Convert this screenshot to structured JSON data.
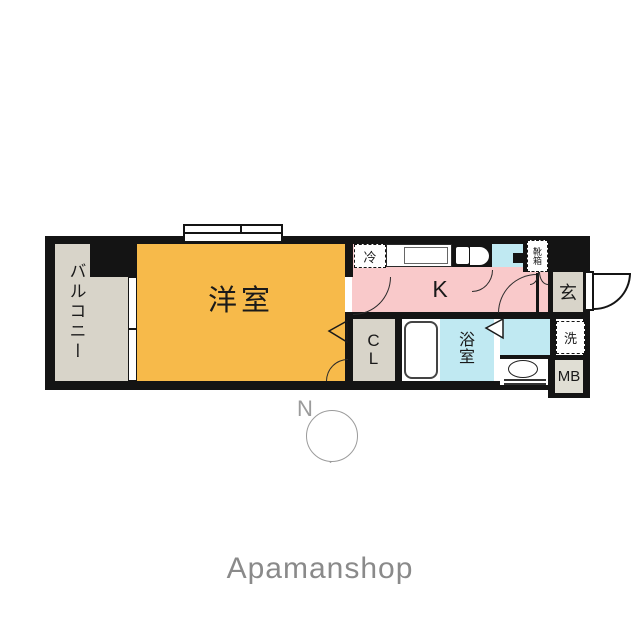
{
  "floorplan": {
    "rooms": {
      "balcony": {
        "label": "バルコニー"
      },
      "western_room": {
        "label": "洋室"
      },
      "kitchen": {
        "label": "K"
      },
      "closet": {
        "label": "C\nL"
      },
      "bathroom": {
        "label": "浴\n室"
      },
      "entrance": {
        "label": "玄"
      },
      "meter_box": {
        "label": "MB"
      }
    },
    "fixtures": {
      "refrigerator": {
        "label": "冷"
      },
      "washer": {
        "label": "洗"
      },
      "shoebox": {
        "label": "靴箱"
      }
    },
    "compass": {
      "north_label": "N"
    },
    "colors": {
      "wall": "#141414",
      "western_room": "#f7ba4a",
      "kitchen": "#f9c9ca",
      "water_area": "#c0e9f2",
      "gray_area": "#d8d4c9",
      "brand_text": "#8a8a8a"
    }
  },
  "footer": {
    "brand": "Apamanshop"
  }
}
